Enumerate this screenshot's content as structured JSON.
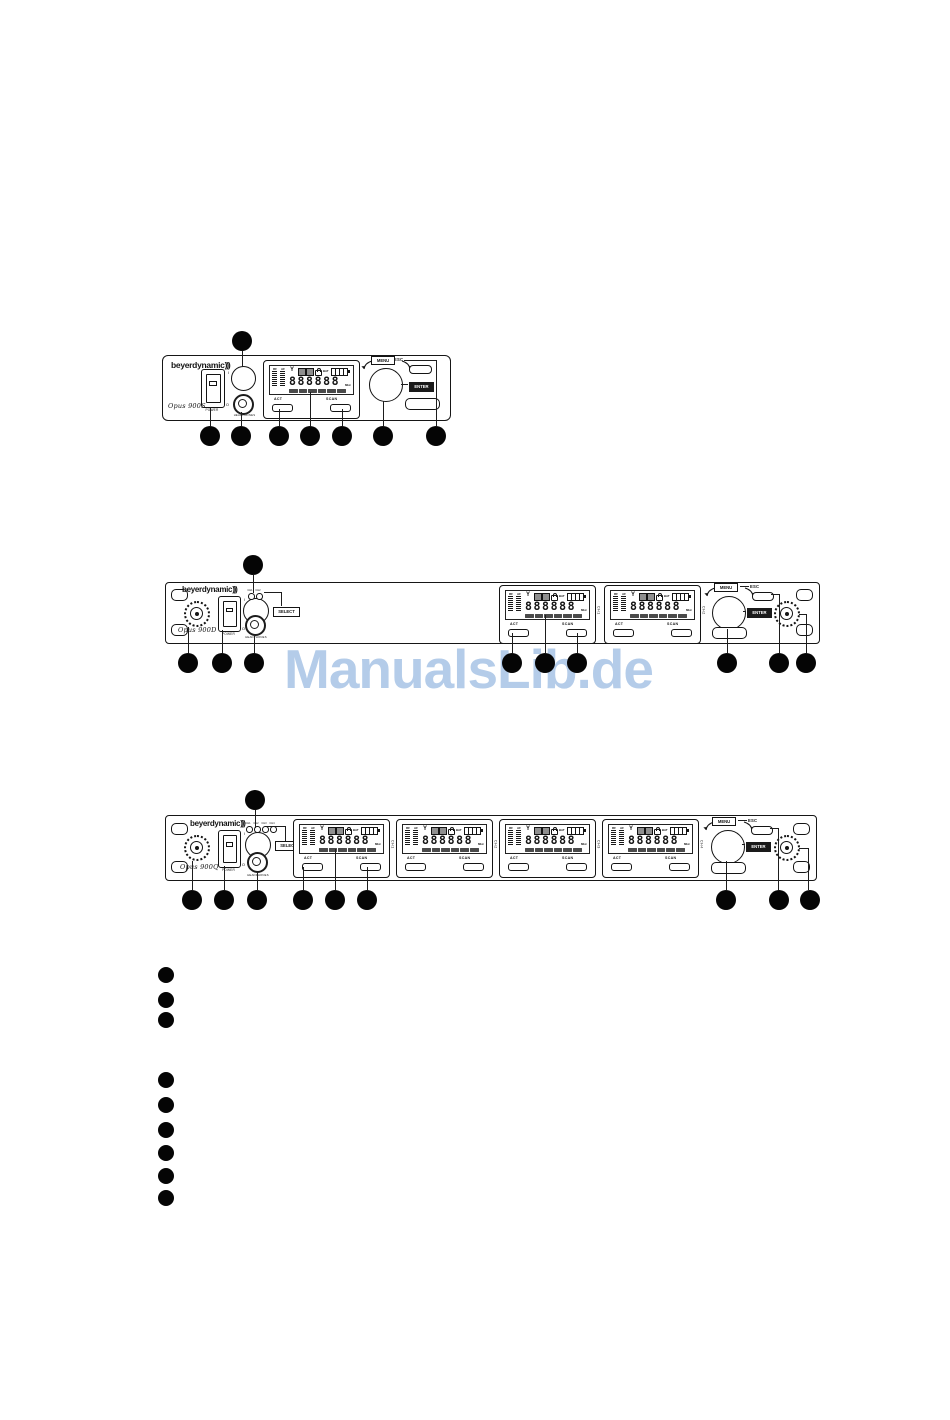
{
  "watermark": {
    "text": "ManualsLib.de",
    "color": "#b4cce9"
  },
  "shared": {
    "brand": "beyerdynamic",
    "brand_mark": ")))",
    "power_label": "POWER",
    "switch_on_mark": "I",
    "switch_off_mark": "O",
    "headphones_label": "HEADPHONES",
    "select_label": "SELECT",
    "menu_label": "MENU",
    "esc_label": "ESC",
    "enter_label": "ENTER",
    "display": {
      "rf_label": "RF",
      "af_label": "AF",
      "bat_label": "BAT",
      "digits": "888888",
      "unit_label": "MHz",
      "act_label": "ACT",
      "scan_label": "SCAN"
    }
  },
  "devices": [
    {
      "model": "Opus 900S",
      "channels": [
        ""
      ],
      "leds": []
    },
    {
      "model": "Opus 900D",
      "channels": [
        "CH1",
        "CH2"
      ],
      "leds": [
        "CH1",
        "CH2"
      ]
    },
    {
      "model": "Opus 900Q",
      "channels": [
        "CH1",
        "CH2",
        "CH3",
        "CH4"
      ],
      "leds": [
        "CH1",
        "CH2",
        "CH3",
        "CH4"
      ]
    }
  ],
  "callout_markers": {
    "device_1": {
      "above": 1,
      "below": 7
    },
    "device_2": {
      "above": 1,
      "below": 9
    },
    "device_3": {
      "above": 1,
      "below": 9
    },
    "bullet_list_1": 3,
    "bullet_list_2": 6
  },
  "icons": {
    "antenna-icon": "Y",
    "lock-icon": "padlock",
    "battery-icon": "segmented battery gauge",
    "menu-arrows-icon": "curved rotate arrows",
    "headphone-jack": "concentric jack socket",
    "antenna-connector": "knurled coax socket",
    "channel-led": "small round LED"
  }
}
